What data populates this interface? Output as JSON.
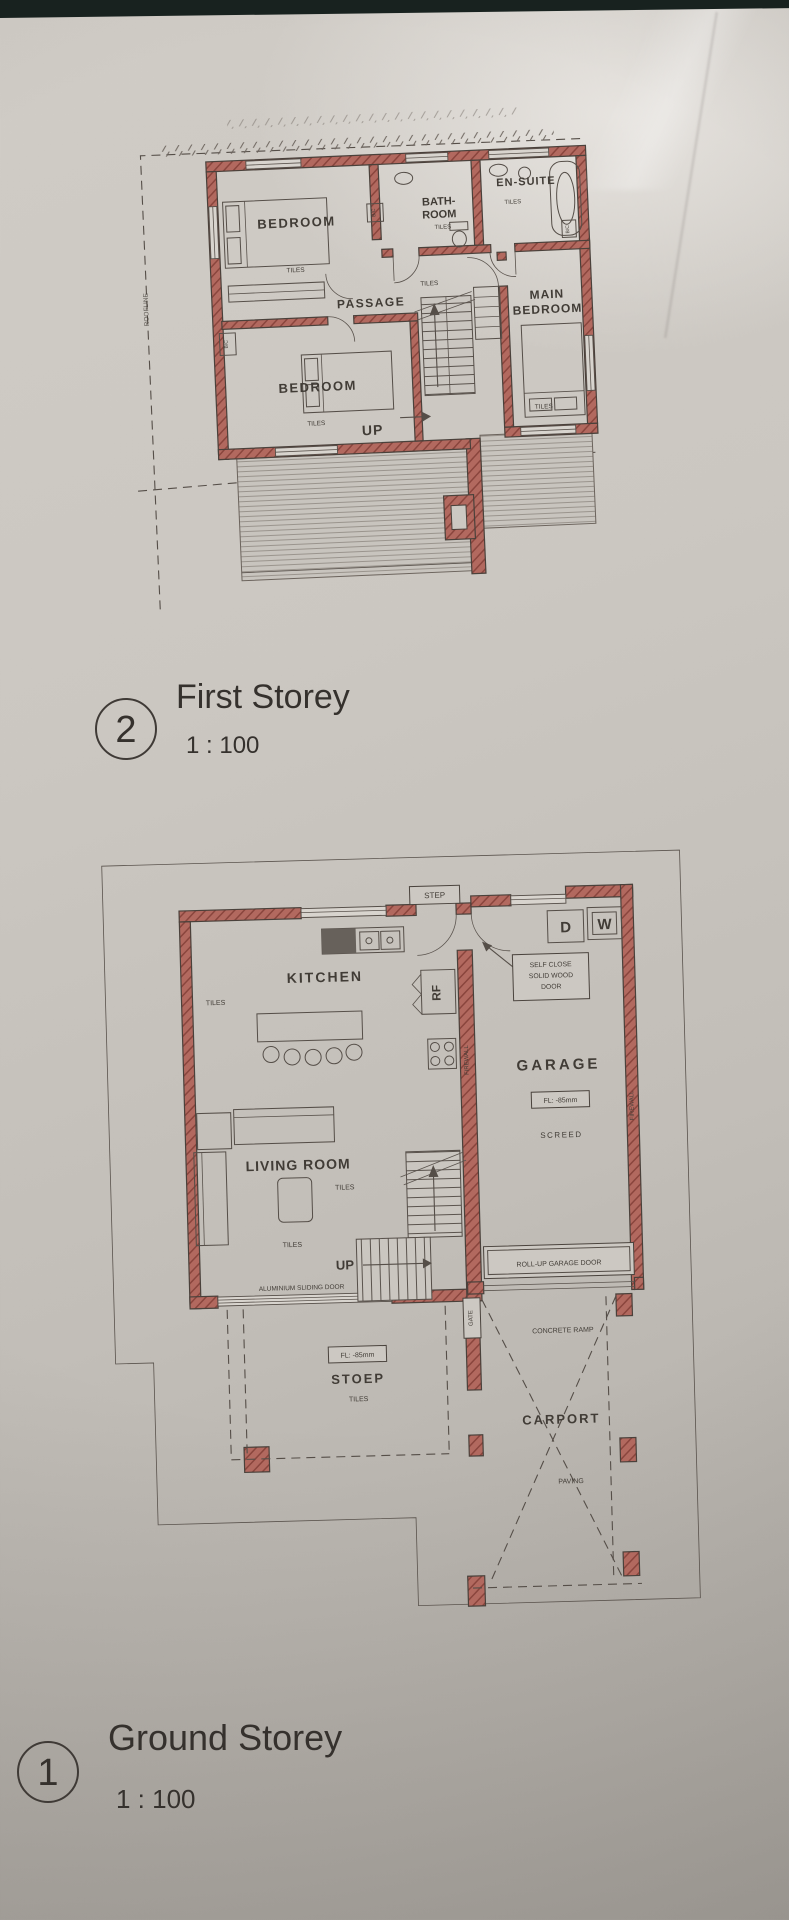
{
  "photo": {
    "strip_color": "#18221f"
  },
  "colors": {
    "wall_red": "#b2695f",
    "wall_hatch": "#8a453d",
    "paper": "#c9c5bf",
    "line": "#554e48",
    "ink": "#413c36"
  },
  "first_storey": {
    "number": "2",
    "title": "First Storey",
    "scale": "1 : 100",
    "labels": {
      "bedroom": "BEDROOM",
      "bath_1": "BATH-",
      "bath_2": "ROOM",
      "ensuite": "EN-SUITE",
      "passage": "PASSAGE",
      "main_1": "MAIN",
      "main_2": "BEDROOM",
      "bedroom2": "BEDROOM",
      "tiles": "TILES",
      "up": "UP",
      "roofline": "ROOFLINE : 600mm OVERHANG",
      "roofline_side": "ROOFLINE",
      "bc": "B/C"
    }
  },
  "ground_storey": {
    "number": "1",
    "title": "Ground Storey",
    "scale": "1 : 100",
    "labels": {
      "step": "STEP",
      "kitchen": "KITCHEN",
      "tiles": "TILES",
      "rf": "RF",
      "self_close_1": "SELF CLOSE",
      "self_close_2": "SOLID WOOD",
      "self_close_3": "DOOR",
      "d": "D",
      "w": "W",
      "garage": "GARAGE",
      "fl": "FL: -85mm",
      "screed": "SCREED",
      "firewall": "FIREWALL",
      "living": "LIVING ROOM",
      "up": "UP",
      "sliding": "ALUMINIUM SLIDING DOOR",
      "rollup": "ROLL-UP GARAGE DOOR",
      "gate": "GATE",
      "ramp": "CONCRETE RAMP",
      "carport": "CARPORT",
      "paving": "PAVING",
      "stoep": "STOEP"
    }
  }
}
